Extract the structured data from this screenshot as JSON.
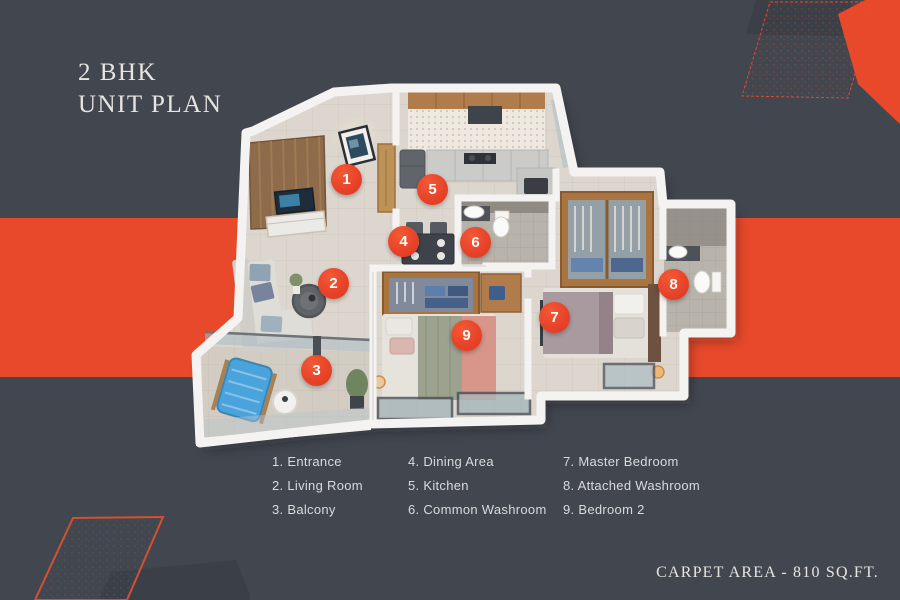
{
  "title": {
    "line1": "2 BHK",
    "line2": "UNIT PLAN"
  },
  "footer": {
    "carpet_area": "CARPET AREA - 810 SQ.FT."
  },
  "legend": {
    "columns": [
      [
        "1. Entrance",
        "2. Living Room",
        "3. Balcony"
      ],
      [
        "4. Dining Area",
        "5. Kitchen",
        "6. Common Washroom"
      ],
      [
        "7. Master Bedroom",
        "8. Attached Washroom",
        "9. Bedroom 2"
      ]
    ]
  },
  "markers": [
    {
      "number": "1",
      "room": "Entrance"
    },
    {
      "number": "2",
      "room": "Living Room"
    },
    {
      "number": "3",
      "room": "Balcony"
    },
    {
      "number": "4",
      "room": "Dining Area"
    },
    {
      "number": "5",
      "room": "Kitchen"
    },
    {
      "number": "6",
      "room": "Common Washroom"
    },
    {
      "number": "7",
      "room": "Master Bedroom"
    },
    {
      "number": "8",
      "room": "Attached Washroom"
    },
    {
      "number": "9",
      "room": "Bedroom 2"
    }
  ],
  "colors": {
    "background": "#42464F",
    "accent_orange": "#E8492B",
    "marker_orange": "#E8432A",
    "text_light": "#E7E5E2",
    "legend_text": "#D9DADC"
  }
}
